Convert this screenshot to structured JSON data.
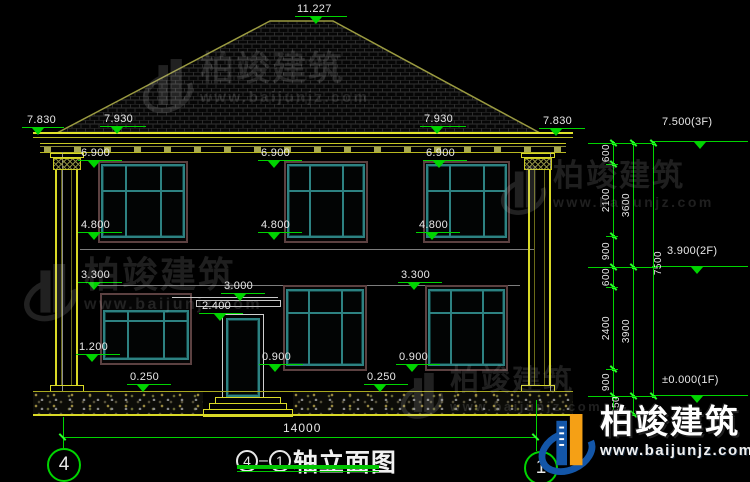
{
  "drawing_title": {
    "axis_start": "4",
    "axis_end": "1",
    "text": "轴立面图"
  },
  "bottom_dimension": "14000",
  "axis_bubbles": {
    "left": "4",
    "right": "1"
  },
  "watermark": {
    "name": "柏竣建筑",
    "url": "www.baijunjz.com"
  },
  "brand": {
    "name": "柏竣建筑",
    "url": "www.baijunjz.com"
  },
  "colors": {
    "dim_green": "#00d400",
    "bright_green": "#2aff2a",
    "cad_yellow": "#d9d926",
    "window_teal": "#2d8282",
    "trim_brown": "#5c4141",
    "text": "#e8e8e8",
    "logo_blue": "#1356a8",
    "logo_orange": "#f5a015"
  },
  "level_annotations": [
    {
      "label": "11.227",
      "tx": 297,
      "ty": 3,
      "x1": 295,
      "x2": 347,
      "ly": 16,
      "trix": 316
    },
    {
      "label": "7.830",
      "tx": 27,
      "ty": 114,
      "x1": 22,
      "x2": 64,
      "ly": 127,
      "trix": 38
    },
    {
      "label": "7.930",
      "tx": 104,
      "ty": 113,
      "x1": 100,
      "x2": 146,
      "ly": 126,
      "trix": 117
    },
    {
      "label": "7.930",
      "tx": 424,
      "ty": 113,
      "x1": 420,
      "x2": 466,
      "ly": 126,
      "trix": 437
    },
    {
      "label": "7.830",
      "tx": 543,
      "ty": 115,
      "x1": 539,
      "x2": 585,
      "ly": 128,
      "trix": 556
    },
    {
      "label": "6.900",
      "tx": 81,
      "ty": 147,
      "x1": 78,
      "x2": 122,
      "ly": 160,
      "trix": 94
    },
    {
      "label": "6.900",
      "tx": 261,
      "ty": 147,
      "x1": 258,
      "x2": 302,
      "ly": 160,
      "trix": 274
    },
    {
      "label": "6.900",
      "tx": 426,
      "ty": 147,
      "x1": 423,
      "x2": 467,
      "ly": 160,
      "trix": 439
    },
    {
      "label": "4.800",
      "tx": 81,
      "ty": 219,
      "x1": 78,
      "x2": 122,
      "ly": 232,
      "trix": 94
    },
    {
      "label": "4.800",
      "tx": 261,
      "ty": 219,
      "x1": 258,
      "x2": 302,
      "ly": 232,
      "trix": 274
    },
    {
      "label": "4.800",
      "tx": 419,
      "ty": 219,
      "x1": 416,
      "x2": 460,
      "ly": 232,
      "trix": 432
    },
    {
      "label": "3.300",
      "tx": 81,
      "ty": 269,
      "x1": 78,
      "x2": 122,
      "ly": 282,
      "trix": 94
    },
    {
      "label": "3.300",
      "tx": 401,
      "ty": 269,
      "x1": 398,
      "x2": 442,
      "ly": 282,
      "trix": 414
    },
    {
      "label": "3.000",
      "tx": 224,
      "ty": 280,
      "x1": 221,
      "x2": 265,
      "ly": 293,
      "trix": 240
    },
    {
      "label": "2.400",
      "tx": 202,
      "ty": 300,
      "x1": 199,
      "x2": 243,
      "ly": 313,
      "trix": 220
    },
    {
      "label": "1.200",
      "tx": 79,
      "ty": 341,
      "x1": 76,
      "x2": 120,
      "ly": 354,
      "trix": 92
    },
    {
      "label": "0.900",
      "tx": 262,
      "ty": 351,
      "x1": 259,
      "x2": 303,
      "ly": 364,
      "trix": 275
    },
    {
      "label": "0.900",
      "tx": 399,
      "ty": 351,
      "x1": 396,
      "x2": 440,
      "ly": 364,
      "trix": 412
    },
    {
      "label": "0.250",
      "tx": 130,
      "ty": 371,
      "x1": 127,
      "x2": 171,
      "ly": 384,
      "trix": 143
    },
    {
      "label": "0.250",
      "tx": 367,
      "ty": 371,
      "x1": 364,
      "x2": 408,
      "ly": 384,
      "trix": 380
    }
  ],
  "floor_levels": [
    {
      "label": "7.500(3F)",
      "tx": 662,
      "ty": 116,
      "x1": 652,
      "x2": 748,
      "ly": 141,
      "trix": 700
    },
    {
      "label": "3.900(2F)",
      "tx": 667,
      "ty": 245,
      "x1": 652,
      "x2": 748,
      "ly": 266,
      "trix": 697
    },
    {
      "label": "±0.000(1F)",
      "tx": 662,
      "ty": 374,
      "x1": 652,
      "x2": 748,
      "ly": 395,
      "trix": 697
    }
  ],
  "dim_chains": {
    "lines": [
      {
        "x": 613,
        "y1": 141,
        "y2": 414
      },
      {
        "x": 633,
        "y1": 141,
        "y2": 414
      },
      {
        "x": 653,
        "y1": 141,
        "y2": 396
      }
    ],
    "ticks": [
      {
        "x": 613,
        "ys": [
          143,
          164,
          236,
          267,
          287,
          369,
          396,
          414
        ]
      },
      {
        "x": 633,
        "ys": [
          143,
          267,
          396,
          414
        ]
      },
      {
        "x": 653,
        "ys": [
          143,
          396
        ]
      }
    ],
    "labels": [
      {
        "label": "600",
        "x": 606,
        "y": 153
      },
      {
        "label": "2100",
        "x": 606,
        "y": 200
      },
      {
        "label": "900",
        "x": 606,
        "y": 251
      },
      {
        "label": "600",
        "x": 606,
        "y": 277
      },
      {
        "label": "2400",
        "x": 606,
        "y": 328
      },
      {
        "label": "900",
        "x": 606,
        "y": 382
      },
      {
        "label": "450",
        "x": 616,
        "y": 405
      },
      {
        "label": "3600",
        "x": 626,
        "y": 205
      },
      {
        "label": "3900",
        "x": 626,
        "y": 331
      },
      {
        "label": "7500",
        "x": 658,
        "y": 263
      }
    ],
    "connectors": [
      {
        "x1": 588,
        "x2": 656,
        "y": 143
      },
      {
        "x1": 606,
        "x2": 618,
        "y": 164
      },
      {
        "x1": 606,
        "x2": 618,
        "y": 236
      },
      {
        "x1": 588,
        "x2": 656,
        "y": 267
      },
      {
        "x1": 606,
        "x2": 618,
        "y": 287
      },
      {
        "x1": 606,
        "x2": 618,
        "y": 369
      },
      {
        "x1": 588,
        "x2": 656,
        "y": 396
      },
      {
        "x1": 606,
        "x2": 638,
        "y": 414
      }
    ]
  },
  "windows": [
    {
      "x": 98,
      "y": 161,
      "w": 90,
      "h": 82,
      "pt": 3,
      "transom": 0.35
    },
    {
      "x": 284,
      "y": 161,
      "w": 84,
      "h": 82,
      "pt": 3,
      "transom": 0.35
    },
    {
      "x": 423,
      "y": 161,
      "w": 87,
      "h": 82,
      "pt": 3,
      "transom": 0.35
    },
    {
      "x": 100,
      "y": 293,
      "w": 92,
      "h": 72,
      "pt": 17,
      "transom": 0.2
    },
    {
      "x": 283,
      "y": 285,
      "w": 84,
      "h": 86,
      "pt": 4,
      "transom": 0.3
    },
    {
      "x": 425,
      "y": 285,
      "w": 83,
      "h": 86,
      "pt": 4,
      "transom": 0.3
    }
  ],
  "gray_watermarks": [
    {
      "lx": 142,
      "ly": 52,
      "tx": 197,
      "ty": 57,
      "scale": 1.0
    },
    {
      "lx": 23,
      "ly": 257,
      "tx": 84,
      "ty": 262,
      "scale": 1.05
    },
    {
      "lx": 500,
      "ly": 160,
      "tx": 555,
      "ty": 164,
      "scale": 0.9
    },
    {
      "lx": 400,
      "ly": 367,
      "tx": 443,
      "ty": 365,
      "scale": 0.85
    }
  ]
}
